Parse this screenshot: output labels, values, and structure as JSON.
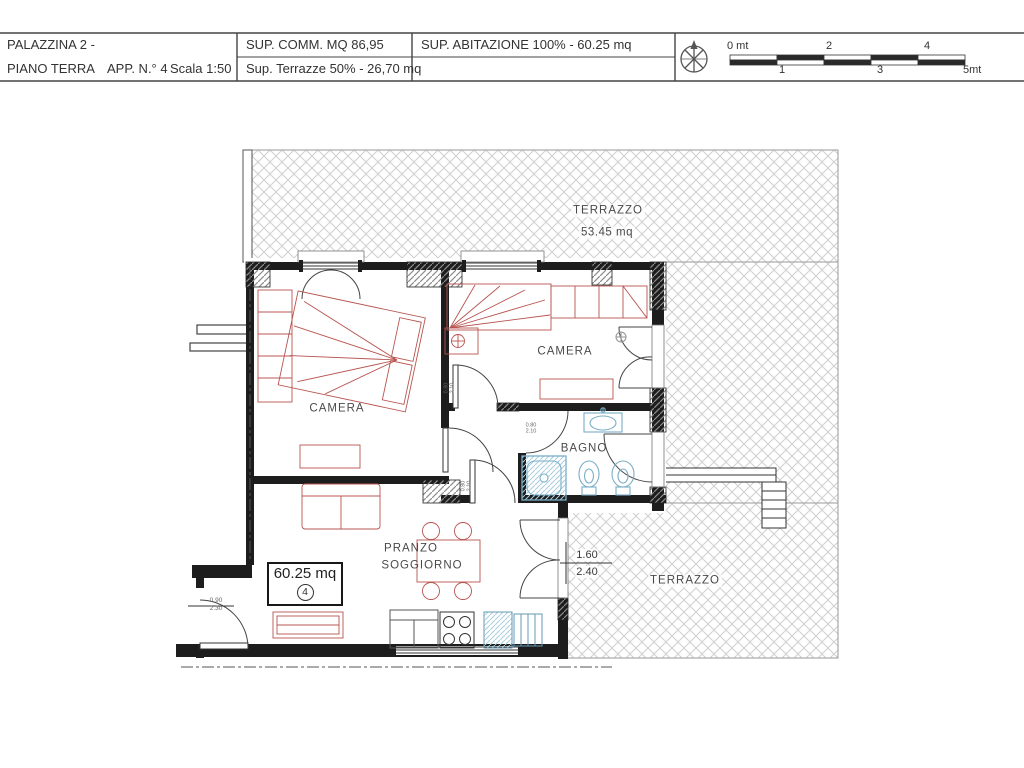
{
  "title_block": {
    "building": "PALAZZINA 2 -",
    "floor": "PIANO TERRA",
    "apartment": "APP. N.° 4",
    "scale": "Scala 1:50",
    "surface_commercial": "SUP. COMM. MQ 86,95",
    "surface_terraces": "Sup. Terrazze 50% - 26,70 mq",
    "surface_habitable": "SUP. ABITAZIONE 100% - 60.25 mq"
  },
  "scale_bar": {
    "zero": "0 mt",
    "one": "1",
    "two": "2",
    "three": "3",
    "four": "4",
    "five": "5mt"
  },
  "plan": {
    "terrace_top": {
      "name": "TERRAZZO",
      "area": "53.45 mq"
    },
    "terrace_bottom": {
      "name": "TERRAZZO"
    },
    "camera_left": "CAMERA",
    "camera_right": "CAMERA",
    "bagno": "BAGNO",
    "living": {
      "line1": "PRANZO",
      "line2": "SOGGIORNO"
    },
    "area_box": {
      "area": "60.25 mq",
      "unit_number": "4"
    },
    "dims": {
      "balcony_door": {
        "w": "1.60",
        "h": "2.40"
      },
      "entrance_door": {
        "w": "0.90",
        "h": "2.30"
      },
      "internal_door_a": {
        "w": "0.80",
        "h": "2.10"
      },
      "internal_door_b": {
        "w": "0.80",
        "h": "2.10"
      },
      "internal_door_c": {
        "w": "0.80",
        "h": "2.10"
      }
    }
  },
  "colors": {
    "wall": "#1d1d1d",
    "furniture_red": "#b85450",
    "fixture_blue": "#7aaec6",
    "terrace_hatch": "#cfcfcf",
    "text": "#3a3a3a"
  }
}
